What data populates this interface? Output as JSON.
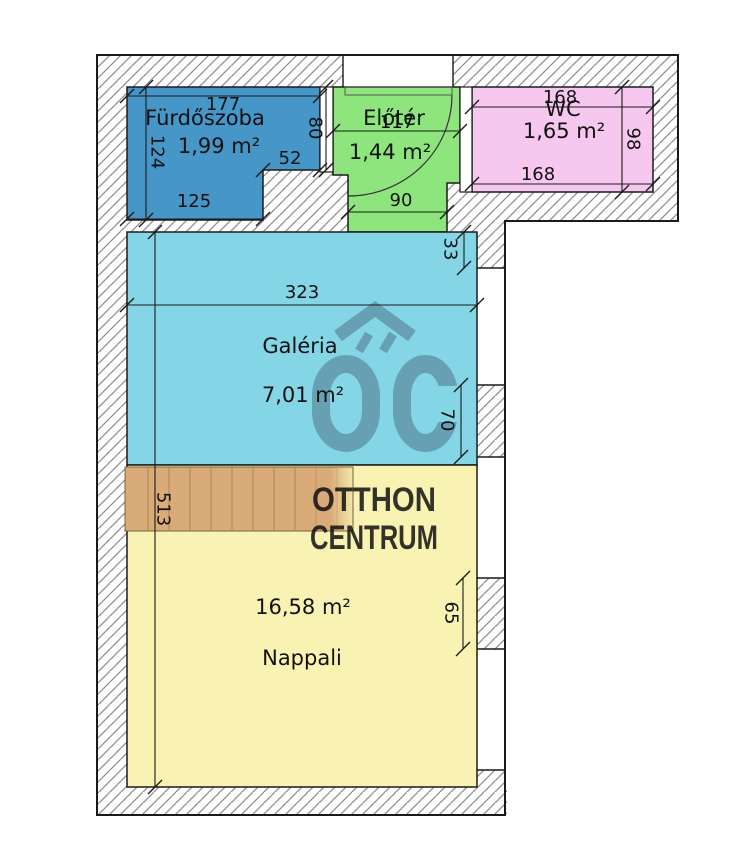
{
  "plan": {
    "rooms": [
      {
        "name": "Fürdőszoba",
        "area": "1,99 m²",
        "color": "#4696c8"
      },
      {
        "name": "Előtér",
        "area": "1,44 m²",
        "color": "#8fe57d"
      },
      {
        "name": "WC",
        "area": "1,65 m²",
        "color": "#f7c8ef"
      },
      {
        "name": "Galéria",
        "area": "7,01 m²",
        "color": "#84d6e7"
      },
      {
        "name": "Nappali",
        "area": "16,58 m²",
        "color": "#f8f3b2"
      }
    ],
    "dimensions_cm": {
      "furdoszoba_width": "177",
      "furdoszoba_height": "124",
      "furdoszoba_bottom": "125",
      "furdoszoba_step": "52",
      "furdoszoba_door": "80",
      "eloter_width": "117",
      "eloter_passage": "90",
      "wc_width_top": "168",
      "wc_width_bottom": "168",
      "wc_height": "98",
      "galeria_wall_top": "33",
      "galeria_width": "323",
      "galeria_wall_right": "70",
      "nappali_height": "513",
      "nappali_wall_right": "65"
    },
    "watermark": {
      "logo_text": "ŐC",
      "line1": "OTTHON",
      "line2": "CENTRUM",
      "logo_color": "#67a0b3",
      "text_color": "#9a957f"
    },
    "stairs_color": "#d9ab79",
    "wall_line_color": "#1a1a1a"
  }
}
